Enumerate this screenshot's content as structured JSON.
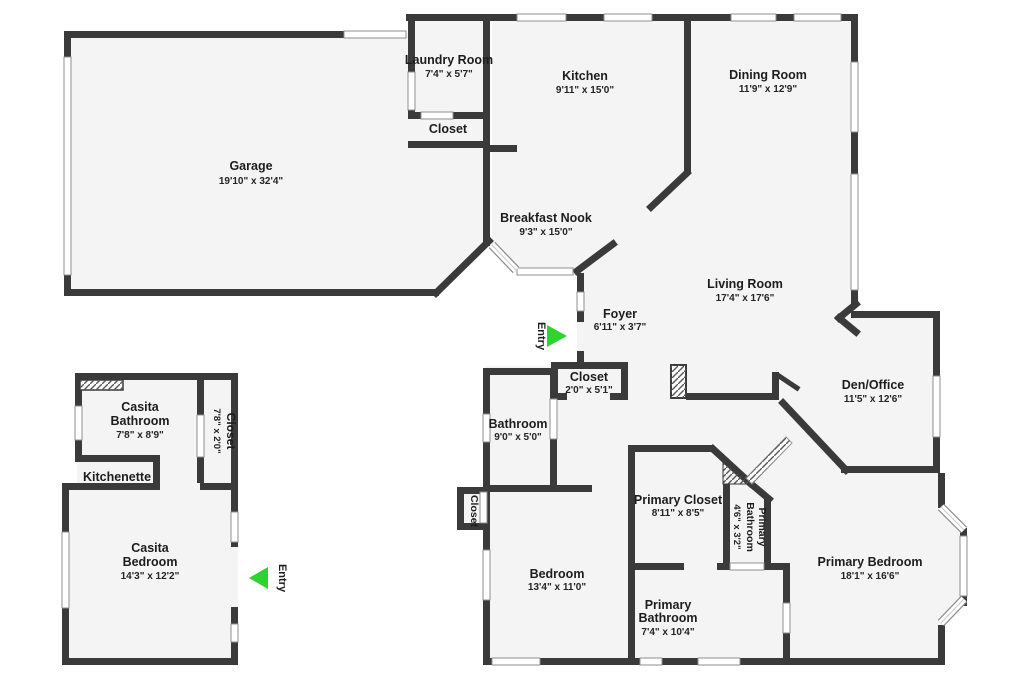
{
  "colors": {
    "wall": "#3a3a3a",
    "floor": "#f4f4f4",
    "background": "#ffffff",
    "entry_arrow": "#2fd32f",
    "label": "#1d1d1d",
    "window_stroke": "#8f8f8f"
  },
  "rooms": {
    "garage": {
      "name": "Garage",
      "dims": "19'10\" x 32'4\""
    },
    "laundry_room": {
      "name": "Laundry Room",
      "dims": "7'4\" x 5'7\""
    },
    "laundry_closet": {
      "name": "Closet"
    },
    "kitchen": {
      "name": "Kitchen",
      "dims": "9'11\" x 15'0\""
    },
    "dining_room": {
      "name": "Dining Room",
      "dims": "11'9\" x 12'9\""
    },
    "breakfast_nook": {
      "name": "Breakfast Nook",
      "dims": "9'3\" x 15'0\""
    },
    "living_room": {
      "name": "Living Room",
      "dims": "17'4\" x 17'6\""
    },
    "foyer": {
      "name": "Foyer",
      "dims": "6'11\" x 3'7\""
    },
    "hall_closet": {
      "name": "Closet",
      "dims": "2'0\" x 5'1\""
    },
    "bathroom": {
      "name": "Bathroom",
      "dims": "9'0\" x 5'0\""
    },
    "bedroom_closet": {
      "name": "Closet"
    },
    "den_office": {
      "name": "Den/Office",
      "dims": "11'5\" x 12'6\""
    },
    "primary_closet": {
      "name": "Primary Closet",
      "dims": "8'11\" x 8'5\""
    },
    "primary_bathroom_small": {
      "name_line1": "Primary",
      "name_line2": "Bathroom",
      "dims": "4'6\" x 3'2\""
    },
    "bedroom": {
      "name": "Bedroom",
      "dims": "13'4\" x 11'0\""
    },
    "primary_bathroom": {
      "name_line1": "Primary",
      "name_line2": "Bathroom",
      "dims": "7'4\" x 10'4\""
    },
    "primary_bedroom": {
      "name": "Primary Bedroom",
      "dims": "18'1\" x 16'6\""
    },
    "casita_bathroom": {
      "name_line1": "Casita",
      "name_line2": "Bathroom",
      "dims": "7'8\" x 8'9\""
    },
    "casita_closet": {
      "name": "Closet",
      "dims": "7'8\" x 2'0\""
    },
    "kitchenette": {
      "name": "Kitchenette"
    },
    "casita_bedroom": {
      "name_line1": "Casita",
      "name_line2": "Bedroom",
      "dims": "14'3\" x 12'2\""
    }
  },
  "entries": {
    "main": {
      "label": "Entry"
    },
    "casita": {
      "label": "Entry"
    }
  }
}
